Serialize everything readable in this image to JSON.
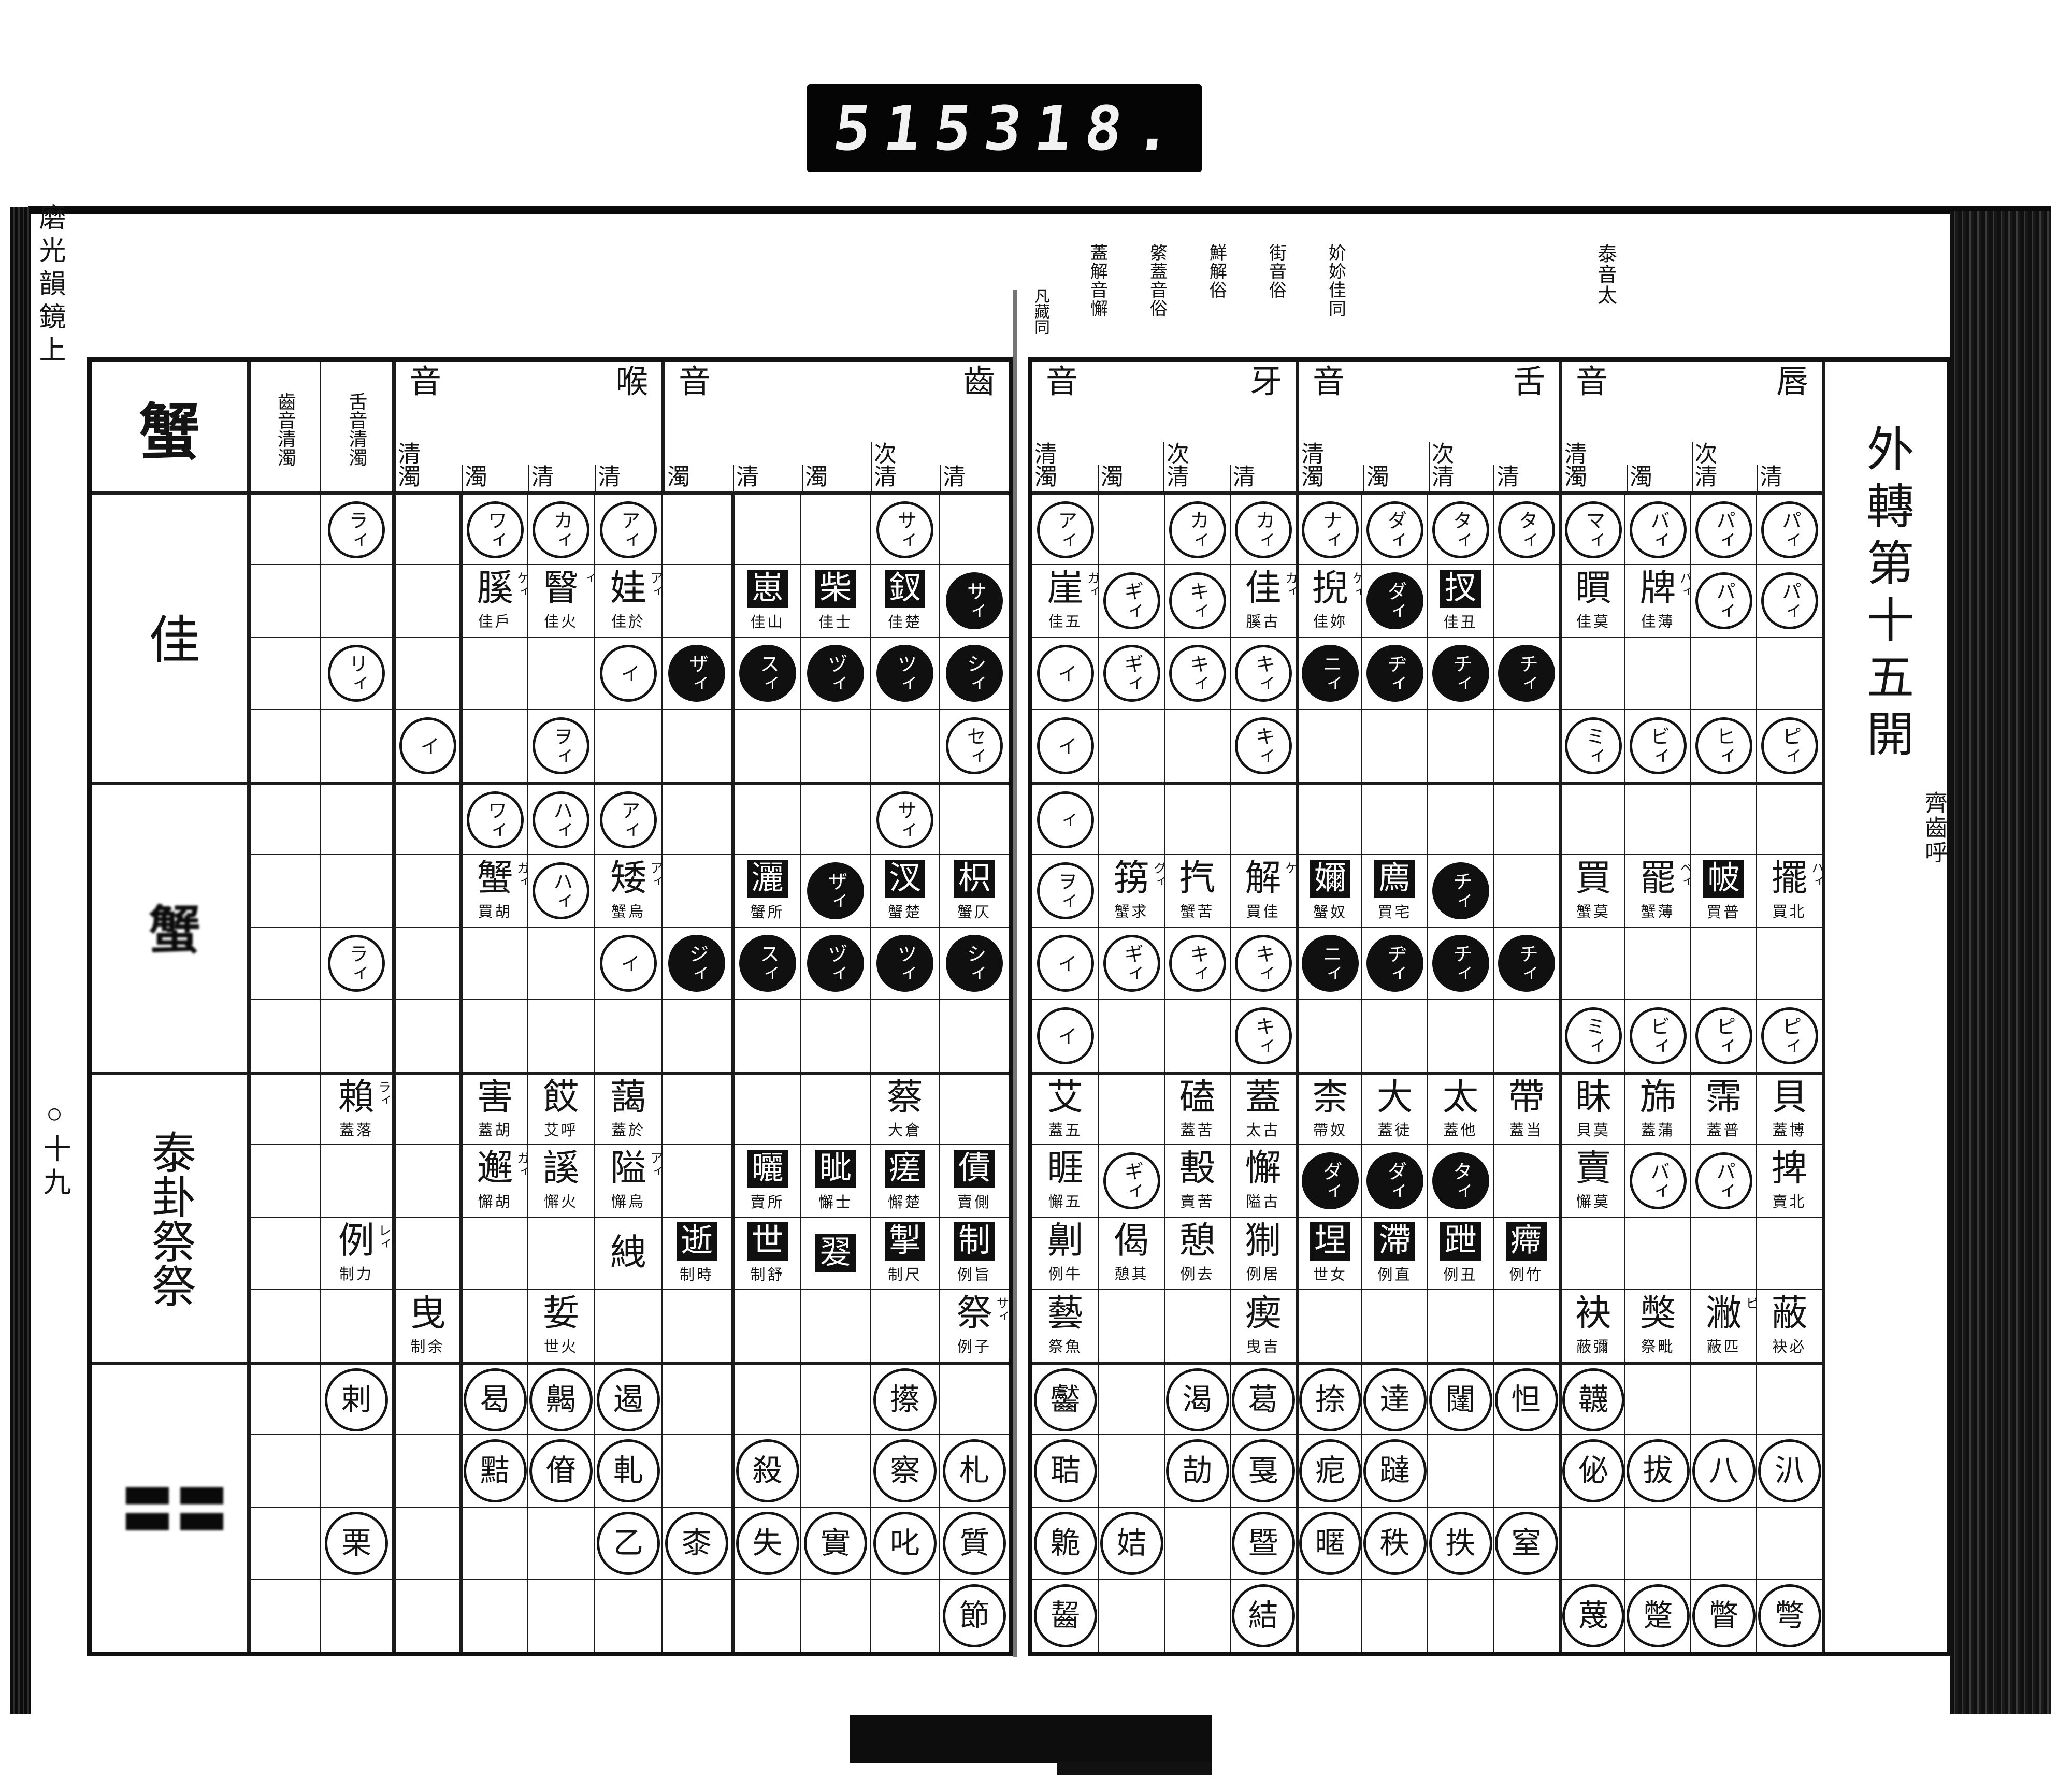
{
  "counter": {
    "left_value": "515",
    "right_value": "318."
  },
  "margin": {
    "edge_title_vertical": "磨光韻鏡上",
    "page_number_vertical": "○十九"
  },
  "right_page": {
    "title": "外轉第十五開",
    "subtitle": "齊齒呼",
    "gutter_note": "凡藏同",
    "notes": [
      "泰音太",
      "妎㚷佳同",
      "街音俗",
      "鮮解俗",
      "綮蓋音俗",
      "蓋解音懈"
    ],
    "groups": [
      {
        "name": "牙音",
        "cols": [
          "清濁",
          "濁",
          "次清",
          "清"
        ]
      },
      {
        "name": "舌音",
        "cols": [
          "清濁",
          "濁",
          "次清",
          "清"
        ]
      },
      {
        "name": "唇音",
        "cols": [
          "清濁",
          "濁",
          "次清",
          "清"
        ]
      }
    ],
    "rows": [
      [
        {
          "t": "c",
          "v": "アィ"
        },
        null,
        {
          "t": "c",
          "v": "カィ"
        },
        {
          "t": "c",
          "v": "カィ"
        },
        {
          "t": "c",
          "v": "ナィ"
        },
        {
          "t": "c",
          "v": "ダィ"
        },
        {
          "t": "c",
          "v": "タィ"
        },
        {
          "t": "c",
          "v": "タィ"
        },
        {
          "t": "c",
          "v": "マィ"
        },
        {
          "t": "c",
          "v": "バィ"
        },
        {
          "t": "c",
          "v": "パィ"
        },
        {
          "t": "c",
          "v": "パィ"
        }
      ],
      [
        {
          "t": "ch",
          "v": "崖",
          "f": "ガィ",
          "s": "佳五"
        },
        {
          "t": "c",
          "v": "ギィ"
        },
        {
          "t": "c",
          "v": "キィ"
        },
        {
          "t": "ch",
          "v": "佳",
          "f": "カィ",
          "s": "膎古"
        },
        {
          "t": "ch",
          "v": "掜",
          "f": "ケィ",
          "s": "佳妳"
        },
        {
          "t": "b",
          "v": "ダィ"
        },
        {
          "t": "bs",
          "v": "扠",
          "s": "佳丑"
        },
        null,
        {
          "t": "ch",
          "v": "䁲",
          "s": "佳莫"
        },
        {
          "t": "ch",
          "v": "牌",
          "f": "バィ",
          "s": "佳薄"
        },
        {
          "t": "c",
          "v": "パィ"
        },
        {
          "t": "c",
          "v": "パィ"
        }
      ],
      [
        {
          "t": "c",
          "v": "イ"
        },
        {
          "t": "c",
          "v": "ギィ"
        },
        {
          "t": "c",
          "v": "キィ"
        },
        {
          "t": "c",
          "v": "キィ"
        },
        {
          "t": "b",
          "v": "ニィ"
        },
        {
          "t": "b",
          "v": "ヂィ"
        },
        {
          "t": "b",
          "v": "チィ"
        },
        {
          "t": "b",
          "v": "チィ"
        },
        null,
        null,
        null,
        null
      ],
      [
        {
          "t": "c",
          "v": "イ"
        },
        null,
        null,
        {
          "t": "c",
          "v": "キィ"
        },
        null,
        null,
        null,
        null,
        {
          "t": "c",
          "v": "ミィ"
        },
        {
          "t": "c",
          "v": "ビィ"
        },
        {
          "t": "c",
          "v": "ヒィ"
        },
        {
          "t": "c",
          "v": "ピィ"
        }
      ],
      [
        {
          "t": "c",
          "v": "ィ"
        },
        null,
        null,
        null,
        null,
        null,
        null,
        null,
        null,
        null,
        null,
        null
      ],
      [
        {
          "t": "c",
          "v": "ヲィ"
        },
        {
          "t": "ch",
          "v": "箉",
          "f": "グィ",
          "s": "蟹求"
        },
        {
          "t": "ch",
          "v": "㧉",
          "s": "蟹苦"
        },
        {
          "t": "ch",
          "v": "解",
          "f": "ケ",
          "s": "買佳"
        },
        {
          "t": "bs",
          "v": "嬭",
          "s": "蟹奴"
        },
        {
          "t": "bs",
          "v": "廌",
          "s": "買宅"
        },
        {
          "t": "b",
          "v": "チィ"
        },
        null,
        {
          "t": "ch",
          "v": "買",
          "s": "蟹莫"
        },
        {
          "t": "ch",
          "v": "罷",
          "f": "ベィ",
          "s": "蟹薄"
        },
        {
          "t": "bs",
          "v": "帔",
          "s": "買普"
        },
        {
          "t": "ch",
          "v": "擺",
          "f": "ハィ",
          "s": "買北"
        }
      ],
      [
        {
          "t": "c",
          "v": "イ"
        },
        {
          "t": "c",
          "v": "ギィ"
        },
        {
          "t": "c",
          "v": "キィ"
        },
        {
          "t": "c",
          "v": "キィ"
        },
        {
          "t": "b",
          "v": "ニィ"
        },
        {
          "t": "b",
          "v": "ヂィ"
        },
        {
          "t": "b",
          "v": "チィ"
        },
        {
          "t": "b",
          "v": "チィ"
        },
        null,
        null,
        null,
        null
      ],
      [
        {
          "t": "c",
          "v": "イ"
        },
        null,
        null,
        {
          "t": "c",
          "v": "キィ"
        },
        null,
        null,
        null,
        null,
        {
          "t": "c",
          "v": "ミィ"
        },
        {
          "t": "c",
          "v": "ビィ"
        },
        {
          "t": "c",
          "v": "ピィ"
        },
        {
          "t": "c",
          "v": "ピィ"
        }
      ],
      [
        {
          "t": "ch",
          "v": "艾",
          "s": "蓋五"
        },
        null,
        {
          "t": "ch",
          "v": "磕",
          "s": "蓋苦"
        },
        {
          "t": "ch",
          "v": "蓋",
          "s": "太古"
        },
        {
          "t": "ch",
          "v": "柰",
          "s": "帶奴"
        },
        {
          "t": "ch",
          "v": "大",
          "s": "蓋徒"
        },
        {
          "t": "ch",
          "v": "太",
          "s": "蓋他"
        },
        {
          "t": "ch",
          "v": "帶",
          "s": "蓋当"
        },
        {
          "t": "ch",
          "v": "眛",
          "s": "貝莫"
        },
        {
          "t": "ch",
          "v": "旆",
          "s": "蓋蒲"
        },
        {
          "t": "ch",
          "v": "霈",
          "s": "蓋普"
        },
        {
          "t": "ch",
          "v": "貝",
          "s": "蓋博"
        }
      ],
      [
        {
          "t": "ch",
          "v": "睚",
          "s": "懈五"
        },
        {
          "t": "c",
          "v": "ギィ"
        },
        {
          "t": "ch",
          "v": "毄",
          "s": "賣苦"
        },
        {
          "t": "ch",
          "v": "懈",
          "s": "隘古"
        },
        {
          "t": "b",
          "v": "ダィ"
        },
        {
          "t": "b",
          "v": "ダィ"
        },
        {
          "t": "b",
          "v": "タィ"
        },
        null,
        {
          "t": "ch",
          "v": "賣",
          "s": "懈莫"
        },
        {
          "t": "c",
          "v": "バィ"
        },
        {
          "t": "c",
          "v": "パィ"
        },
        {
          "t": "ch",
          "v": "捭",
          "s": "賣北"
        }
      ],
      [
        {
          "t": "ch",
          "v": "劓",
          "s": "例牛"
        },
        {
          "t": "ch",
          "v": "偈",
          "s": "憩其"
        },
        {
          "t": "ch",
          "v": "憩",
          "s": "例去"
        },
        {
          "t": "ch",
          "v": "猘",
          "s": "例居"
        },
        {
          "t": "bs",
          "v": "㘿",
          "s": "世女"
        },
        {
          "t": "bs",
          "v": "滯",
          "s": "例直"
        },
        {
          "t": "bs",
          "v": "跇",
          "s": "例丑"
        },
        {
          "t": "bs",
          "v": "㿃",
          "s": "例竹"
        },
        null,
        null,
        null,
        null
      ],
      [
        {
          "t": "ch",
          "v": "藝",
          "s": "祭魚"
        },
        null,
        null,
        {
          "t": "ch",
          "v": "瘈",
          "s": "曳吉"
        },
        null,
        null,
        null,
        null,
        {
          "t": "ch",
          "v": "袂",
          "s": "蔽彌"
        },
        {
          "t": "ch",
          "v": "獘",
          "s": "祭毗"
        },
        {
          "t": "ch",
          "v": "潎",
          "f": "ピ",
          "s": "蔽匹"
        },
        {
          "t": "ch",
          "v": "蔽",
          "s": "袂必"
        }
      ],
      [
        {
          "t": "cc",
          "v": "齾"
        },
        null,
        {
          "t": "cc",
          "v": "渴"
        },
        {
          "t": "cc",
          "v": "葛"
        },
        {
          "t": "cc",
          "v": "捺"
        },
        {
          "t": "cc",
          "v": "達"
        },
        {
          "t": "cc",
          "v": "闥"
        },
        {
          "t": "cc",
          "v": "怛"
        },
        {
          "t": "cc",
          "v": "韤"
        },
        null,
        null,
        null
      ],
      [
        {
          "t": "cc",
          "v": "聐"
        },
        null,
        {
          "t": "cc",
          "v": "劼"
        },
        {
          "t": "cc",
          "v": "戛"
        },
        {
          "t": "cc",
          "v": "痆"
        },
        {
          "t": "cc",
          "v": "躂"
        },
        null,
        null,
        {
          "t": "cc",
          "v": "佖"
        },
        {
          "t": "cc",
          "v": "拔"
        },
        {
          "t": "cc",
          "v": "八"
        },
        {
          "t": "cc",
          "v": "汃"
        }
      ],
      [
        {
          "t": "cc",
          "v": "臲"
        },
        {
          "t": "cc",
          "v": "姞"
        },
        null,
        {
          "t": "cc",
          "v": "暨"
        },
        {
          "t": "cc",
          "v": "暱"
        },
        {
          "t": "cc",
          "v": "秩"
        },
        {
          "t": "cc",
          "v": "抶"
        },
        {
          "t": "cc",
          "v": "窒"
        },
        null,
        null,
        null,
        null
      ],
      [
        {
          "t": "cc",
          "v": "齧"
        },
        null,
        null,
        {
          "t": "cc",
          "v": "結"
        },
        null,
        null,
        null,
        null,
        {
          "t": "cc",
          "v": "蔑"
        },
        {
          "t": "cc",
          "v": "蹩"
        },
        {
          "t": "cc",
          "v": "瞥"
        },
        {
          "t": "cc",
          "v": "彆"
        }
      ]
    ]
  },
  "left_page": {
    "she_label": "蟹",
    "row_groups": [
      "佳",
      "蟹",
      "泰卦祭祭",
      "〓〓"
    ],
    "narrow_headers": [
      "齒音清濁",
      "舌音清濁"
    ],
    "groups": [
      {
        "name": "喉音",
        "cols": [
          "清濁",
          "濁",
          "清",
          "清"
        ]
      },
      {
        "name": "齒音",
        "cols": [
          "濁",
          "清",
          "濁",
          "次清",
          "清"
        ]
      }
    ],
    "rows": [
      [
        null,
        {
          "t": "c",
          "v": "ラィ"
        },
        null,
        {
          "t": "c",
          "v": "ワィ"
        },
        {
          "t": "c",
          "v": "カィ"
        },
        {
          "t": "c",
          "v": "アィ"
        },
        null,
        null,
        null,
        {
          "t": "c",
          "v": "サィ"
        },
        null
      ],
      [
        null,
        null,
        null,
        {
          "t": "ch",
          "v": "膎",
          "f": "ケィ",
          "s": "佳戶"
        },
        {
          "t": "ch",
          "v": "瞖",
          "f": "ィ",
          "s": "佳火"
        },
        {
          "t": "ch",
          "v": "娃",
          "f": "アィ",
          "s": "佳於"
        },
        null,
        {
          "t": "bs",
          "v": "崽",
          "s": "佳山"
        },
        {
          "t": "bs",
          "v": "柴",
          "s": "佳士"
        },
        {
          "t": "bs",
          "v": "釵",
          "s": "佳楚"
        },
        {
          "t": "b",
          "v": "サィ"
        }
      ],
      [
        null,
        {
          "t": "c",
          "v": "リィ"
        },
        null,
        null,
        null,
        {
          "t": "c",
          "v": "イ"
        },
        {
          "t": "b",
          "v": "ザィ"
        },
        {
          "t": "b",
          "v": "スィ"
        },
        {
          "t": "b",
          "v": "ヅィ"
        },
        {
          "t": "b",
          "v": "ツィ"
        },
        {
          "t": "b",
          "v": "シィ"
        }
      ],
      [
        null,
        null,
        {
          "t": "c",
          "v": "イ"
        },
        null,
        {
          "t": "c",
          "v": "ヲィ"
        },
        null,
        null,
        null,
        null,
        null,
        {
          "t": "c",
          "v": "セィ"
        }
      ],
      [
        null,
        null,
        null,
        {
          "t": "c",
          "v": "ワィ"
        },
        {
          "t": "c",
          "v": "ハィ"
        },
        {
          "t": "c",
          "v": "アィ"
        },
        null,
        null,
        null,
        {
          "t": "c",
          "v": "サィ"
        },
        null
      ],
      [
        null,
        null,
        null,
        {
          "t": "ch",
          "v": "蟹",
          "f": "ガィ",
          "s": "買胡"
        },
        {
          "t": "c",
          "v": "ハィ"
        },
        {
          "t": "ch",
          "v": "矮",
          "f": "アィ",
          "s": "蟹烏"
        },
        null,
        {
          "t": "bs",
          "v": "灑",
          "s": "蟹所"
        },
        {
          "t": "b",
          "v": "ザィ"
        },
        {
          "t": "bs",
          "v": "汊",
          "s": "蟹楚"
        },
        {
          "t": "bs",
          "v": "枳",
          "s": "蟹仄"
        }
      ],
      [
        null,
        {
          "t": "c",
          "v": "ラィ"
        },
        null,
        null,
        null,
        {
          "t": "c",
          "v": "イ"
        },
        {
          "t": "b",
          "v": "ジィ"
        },
        {
          "t": "b",
          "v": "スィ"
        },
        {
          "t": "b",
          "v": "ヅィ"
        },
        {
          "t": "b",
          "v": "ツィ"
        },
        {
          "t": "b",
          "v": "シィ"
        }
      ],
      [
        null,
        null,
        null,
        null,
        null,
        null,
        null,
        null,
        null,
        null,
        null
      ],
      [
        null,
        {
          "t": "ch",
          "v": "賴",
          "f": "ラィ",
          "s": "蓋落"
        },
        null,
        {
          "t": "ch",
          "v": "害",
          "s": "蓋胡"
        },
        {
          "t": "ch",
          "v": "餀",
          "s": "艾呼"
        },
        {
          "t": "ch",
          "v": "藹",
          "s": "蓋於"
        },
        null,
        null,
        null,
        {
          "t": "ch",
          "v": "蔡",
          "s": "大倉"
        },
        null
      ],
      [
        null,
        null,
        null,
        {
          "t": "ch",
          "v": "邂",
          "f": "ガィ",
          "s": "懈胡"
        },
        {
          "t": "ch",
          "v": "謑",
          "s": "懈火"
        },
        {
          "t": "ch",
          "v": "隘",
          "f": "アィ",
          "s": "懈烏"
        },
        null,
        {
          "t": "bs",
          "v": "曬",
          "s": "賣所"
        },
        {
          "t": "bs",
          "v": "眦",
          "s": "懈士"
        },
        {
          "t": "bs",
          "v": "瘥",
          "s": "懈楚"
        },
        {
          "t": "bs",
          "v": "債",
          "s": "賣側"
        }
      ],
      [
        null,
        {
          "t": "ch",
          "v": "例",
          "f": "レィ",
          "s": "制力"
        },
        null,
        null,
        null,
        {
          "t": "ch",
          "v": "絏"
        },
        {
          "t": "bs",
          "v": "逝",
          "s": "制時"
        },
        {
          "t": "bs",
          "v": "世",
          "s": "制舒"
        },
        {
          "t": "bs",
          "v": "翇"
        },
        {
          "t": "bs",
          "v": "掣",
          "s": "制尺"
        },
        {
          "t": "bs",
          "v": "制",
          "s": "例旨"
        }
      ],
      [
        null,
        null,
        {
          "t": "ch",
          "v": "曳",
          "s": "制余"
        },
        null,
        {
          "t": "ch",
          "v": "娎",
          "s": "世火"
        },
        null,
        null,
        null,
        null,
        null,
        {
          "t": "ch",
          "v": "祭",
          "f": "サィ",
          "s": "例子"
        }
      ],
      [
        null,
        {
          "t": "cc",
          "v": "剌"
        },
        null,
        {
          "t": "cc",
          "v": "曷"
        },
        {
          "t": "cc",
          "v": "齃"
        },
        {
          "t": "cc",
          "v": "遏"
        },
        null,
        null,
        null,
        {
          "t": "cc",
          "v": "攃"
        },
        null
      ],
      [
        null,
        null,
        null,
        {
          "t": "cc",
          "v": "黠"
        },
        {
          "t": "cc",
          "v": "傄"
        },
        {
          "t": "cc",
          "v": "軋"
        },
        null,
        {
          "t": "cc",
          "v": "殺"
        },
        null,
        {
          "t": "cc",
          "v": "察"
        },
        {
          "t": "cc",
          "v": "札"
        }
      ],
      [
        null,
        {
          "t": "cc",
          "v": "栗"
        },
        null,
        null,
        null,
        {
          "t": "cc",
          "v": "乙"
        },
        {
          "t": "cc",
          "v": "桼"
        },
        {
          "t": "cc",
          "v": "失"
        },
        {
          "t": "cc",
          "v": "實"
        },
        {
          "t": "cc",
          "v": "叱"
        },
        {
          "t": "cc",
          "v": "質"
        }
      ],
      [
        null,
        null,
        null,
        null,
        null,
        null,
        null,
        null,
        null,
        null,
        {
          "t": "cc",
          "v": "節"
        }
      ]
    ]
  }
}
